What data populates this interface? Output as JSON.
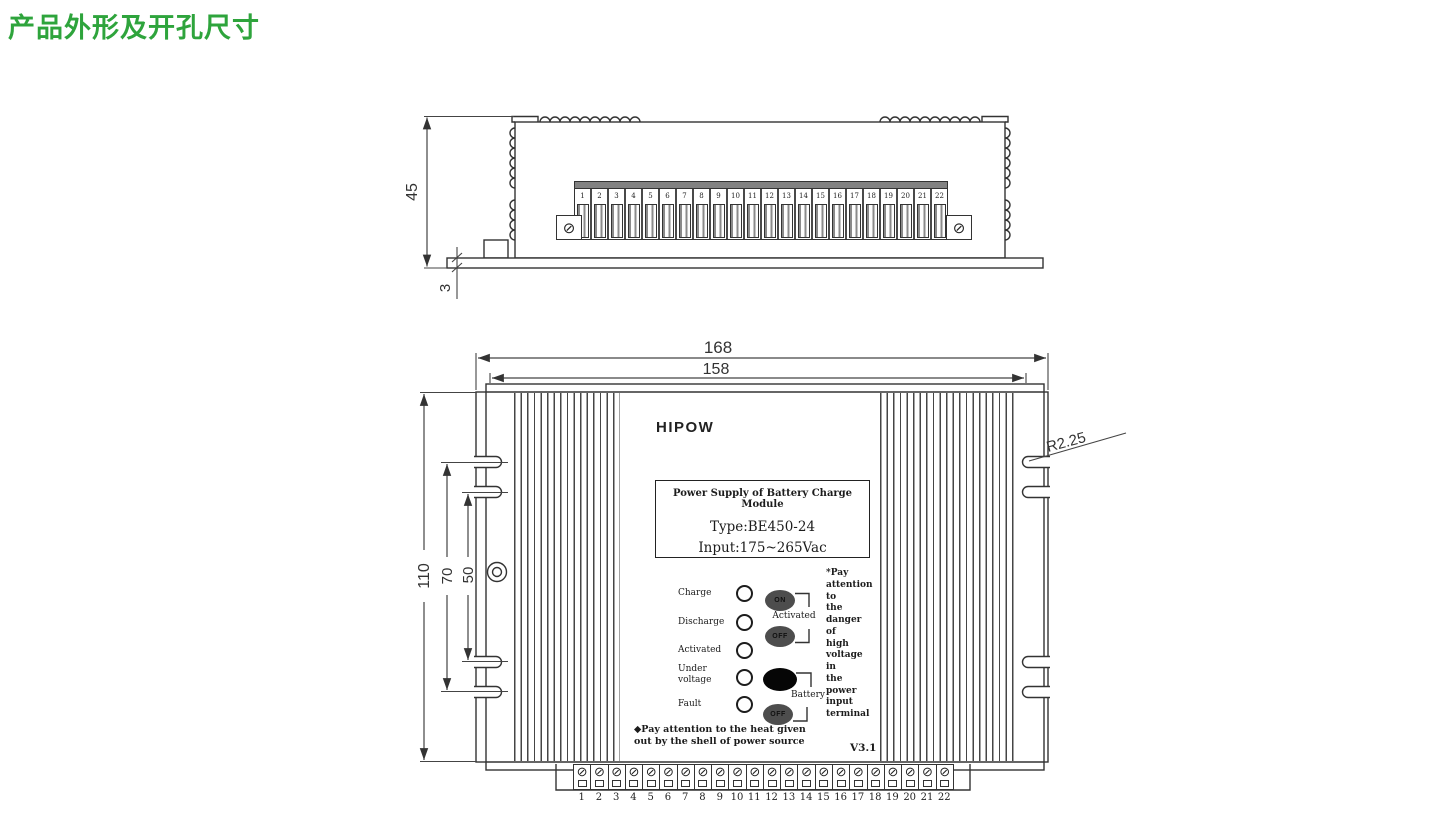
{
  "title": "产品外形及开孔尺寸",
  "colors": {
    "accent": "#2EA43C",
    "line": "#333333"
  },
  "icons": {
    "screw": "⊘"
  },
  "terminals": [
    "1",
    "2",
    "3",
    "4",
    "5",
    "6",
    "7",
    "8",
    "9",
    "10",
    "11",
    "12",
    "13",
    "14",
    "15",
    "16",
    "17",
    "18",
    "19",
    "20",
    "21",
    "22"
  ],
  "top_view": {
    "dim_height": "45",
    "dim_base": "3"
  },
  "front_view": {
    "dim_width_outer": "168",
    "dim_width_inner": "158",
    "dim_height": "110",
    "dim_slot_outer": "70",
    "dim_slot_inner": "50",
    "dim_radius": "R2.25",
    "logo": "HIPOW",
    "label_box": {
      "title": "Power Supply of Battery Charge Module",
      "type": "Type:BE450-24",
      "input": "Input:175~265Vac"
    },
    "led_labels": [
      "Charge",
      "Discharge",
      "Activated",
      "Under voltage",
      "Fault"
    ],
    "switch_on": "ON",
    "switch_off1": "OFF",
    "switch_off2": "OFF",
    "switch_group1_label": "Activated",
    "switch_group2_label": "Battery",
    "warning_lines": [
      "*Pay",
      "attention",
      "to",
      "the",
      "danger",
      "of",
      "high",
      "voltage",
      "in",
      "the",
      "power",
      "input",
      "terminal"
    ],
    "heat_note_line1": "◆Pay attention to the heat given",
    "heat_note_line2": "out by the shell of power source",
    "version": "V3.1"
  }
}
